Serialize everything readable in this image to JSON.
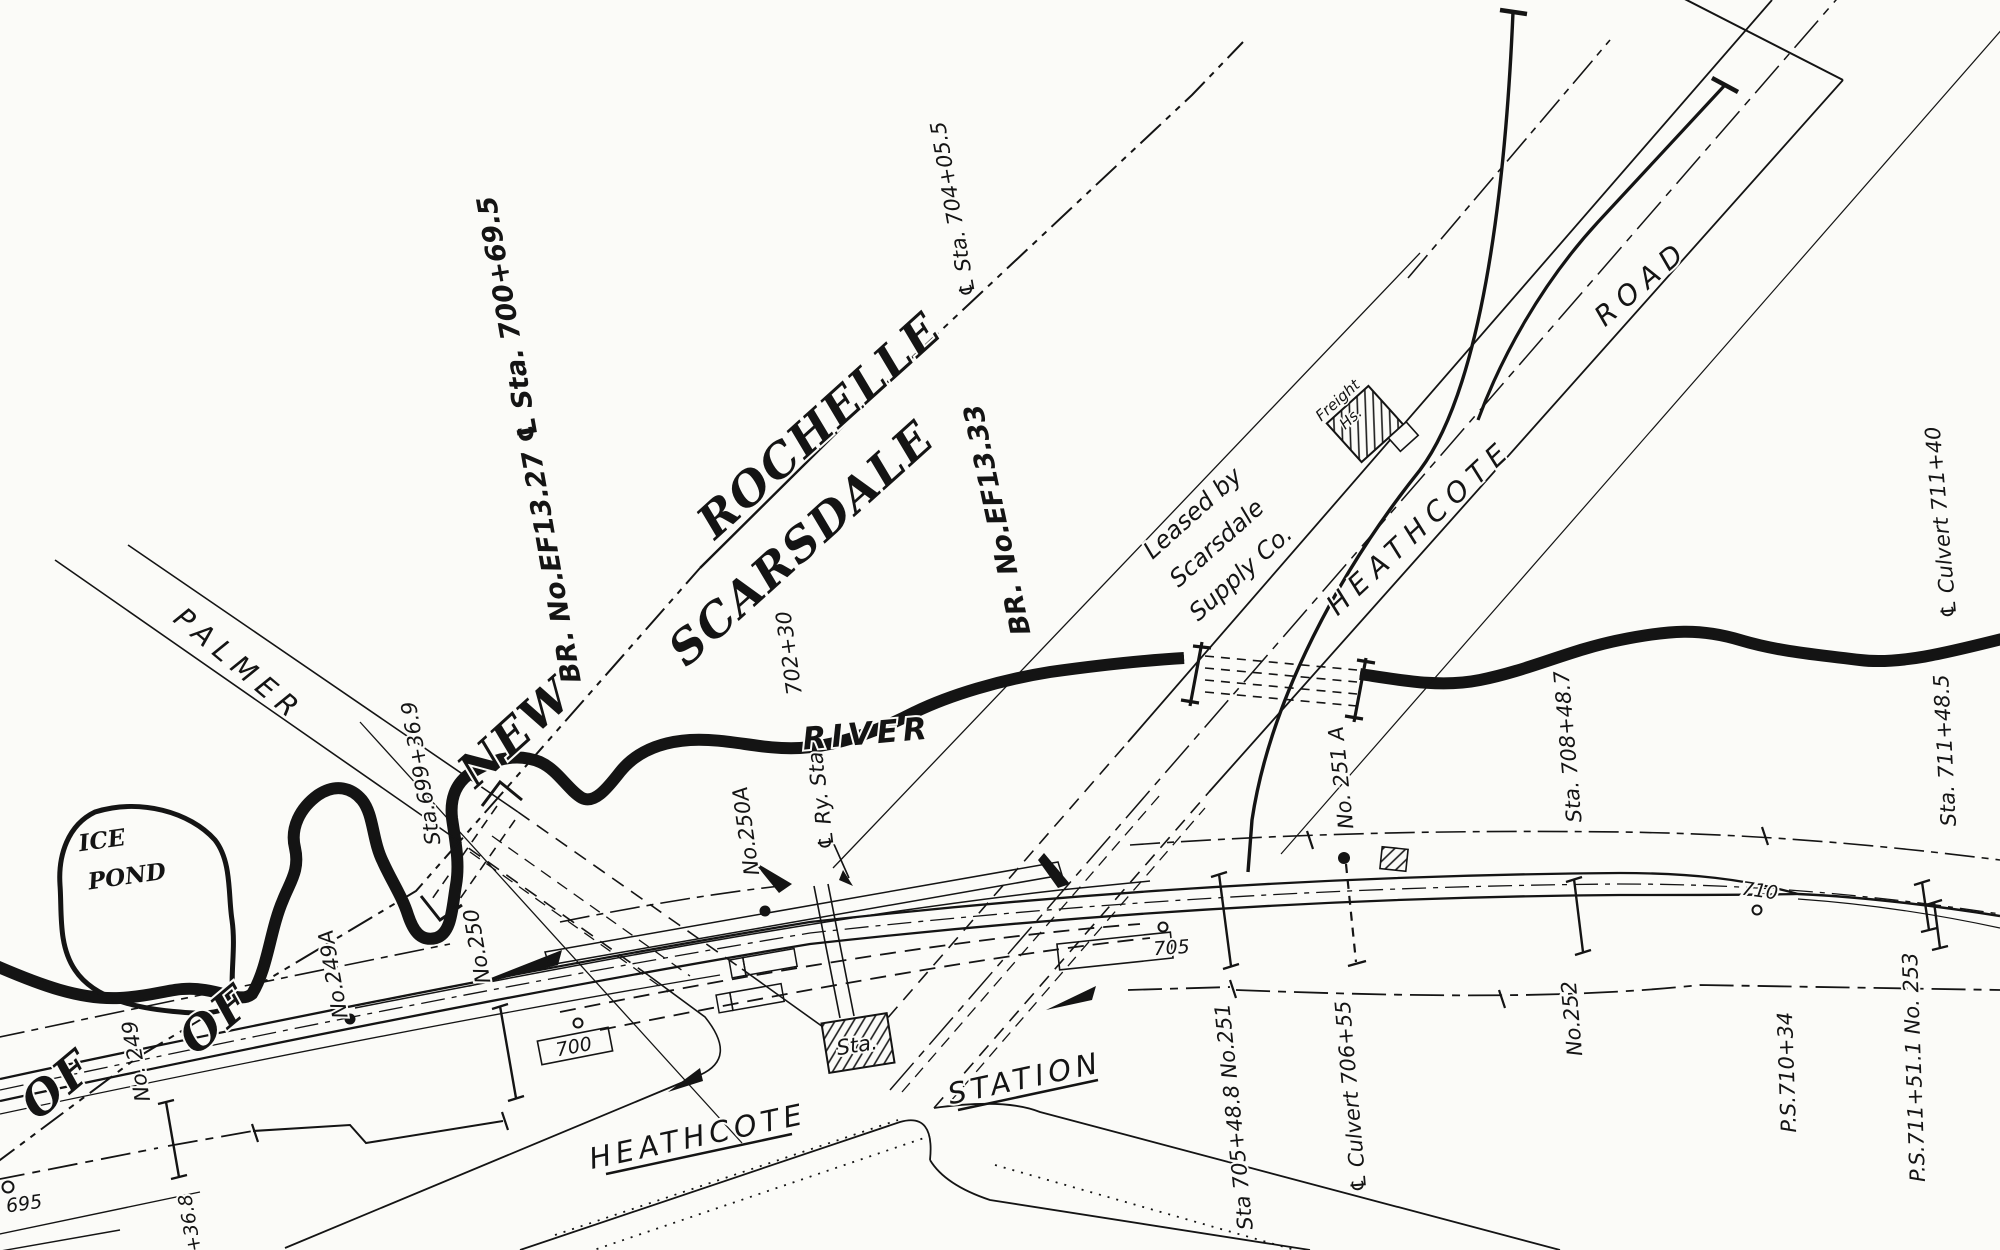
{
  "labels": {
    "town_new": "NEW",
    "town_rochelle": "ROCHELLE",
    "town_scarsdale": "SCARSDALE",
    "boundary_of_1": "OF",
    "boundary_of_2": "OF",
    "bridge_1327": "BR. No.EF13.27 ℄ Sta. 700+69.5",
    "bridge_1333": "BR. No.EF13.33",
    "boundary_sta": "℄ Sta. 704+05.5",
    "leased_1": "Leased by",
    "leased_2": "Scarsdale",
    "leased_3": "Supply Co.",
    "freight_1": "Freight",
    "freight_2": "Hs.",
    "road_palmer": "PALMER",
    "road_heathcote_ne": "HEATHCOTE",
    "road_road": "ROAD",
    "road_heathcote_sw": "HEATHCOTE",
    "road_station": "STATION",
    "ice_1": "ICE",
    "ice_2": "POND",
    "river": "RIVER",
    "sta_699369": "Sta.699+36.9",
    "sta_70230": "702+30",
    "ry_sta": "℄ Ry. Sta",
    "no_249": "No. 249",
    "no_249a": "No.249A",
    "no_250": "No.250",
    "no_250a": "No.250A",
    "no_251a": "No. 251 A",
    "no_252": "No.252",
    "sta_705488": "Sta 705+48.8 No.251",
    "culvert_70655": "℄ Culvert 706+55",
    "sta_708487": "Sta. 708+48.7",
    "sta_711485": "Sta. 711+48.5",
    "culvert_71140": "℄ Culvert 711+40",
    "ps_71034": "P.S.710+34",
    "ps_711511": "P.S.711+51.1 No. 253",
    "mp_695": "695",
    "mp_700": "700",
    "mp_705": "705",
    "mp_710": "710",
    "mp_368": "+36.8",
    "sta_building": "Sta."
  }
}
